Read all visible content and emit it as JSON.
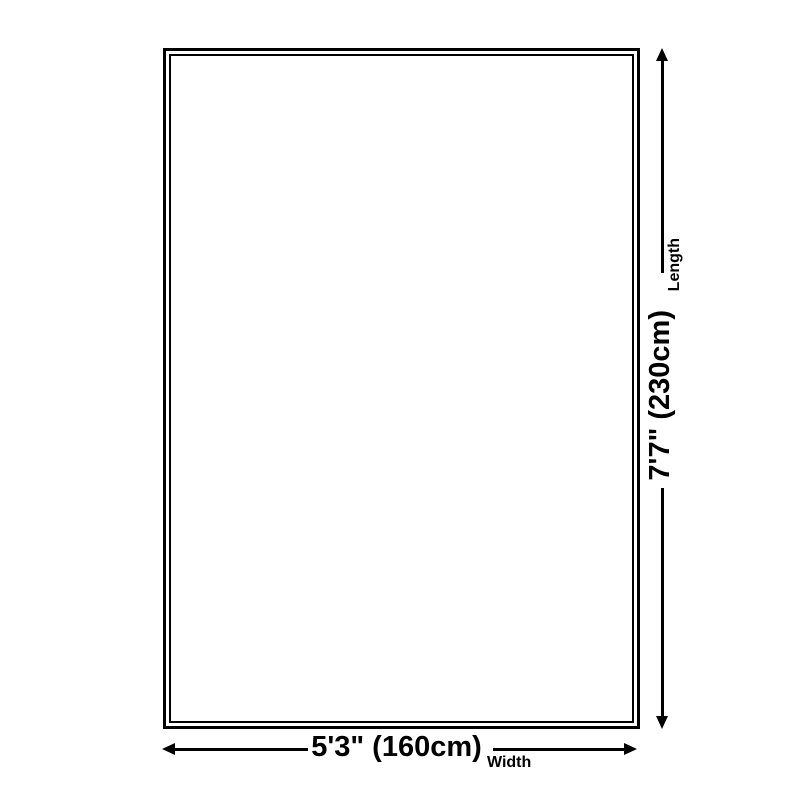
{
  "page": {
    "background_color": "#ffffff",
    "line_color": "#000000"
  },
  "diagram": {
    "type": "product-size-diagram",
    "length": {
      "label": "Length",
      "value": "7'7\" (230cm)"
    },
    "width": {
      "label": "Width",
      "value": "5'3\" (160cm)"
    }
  }
}
